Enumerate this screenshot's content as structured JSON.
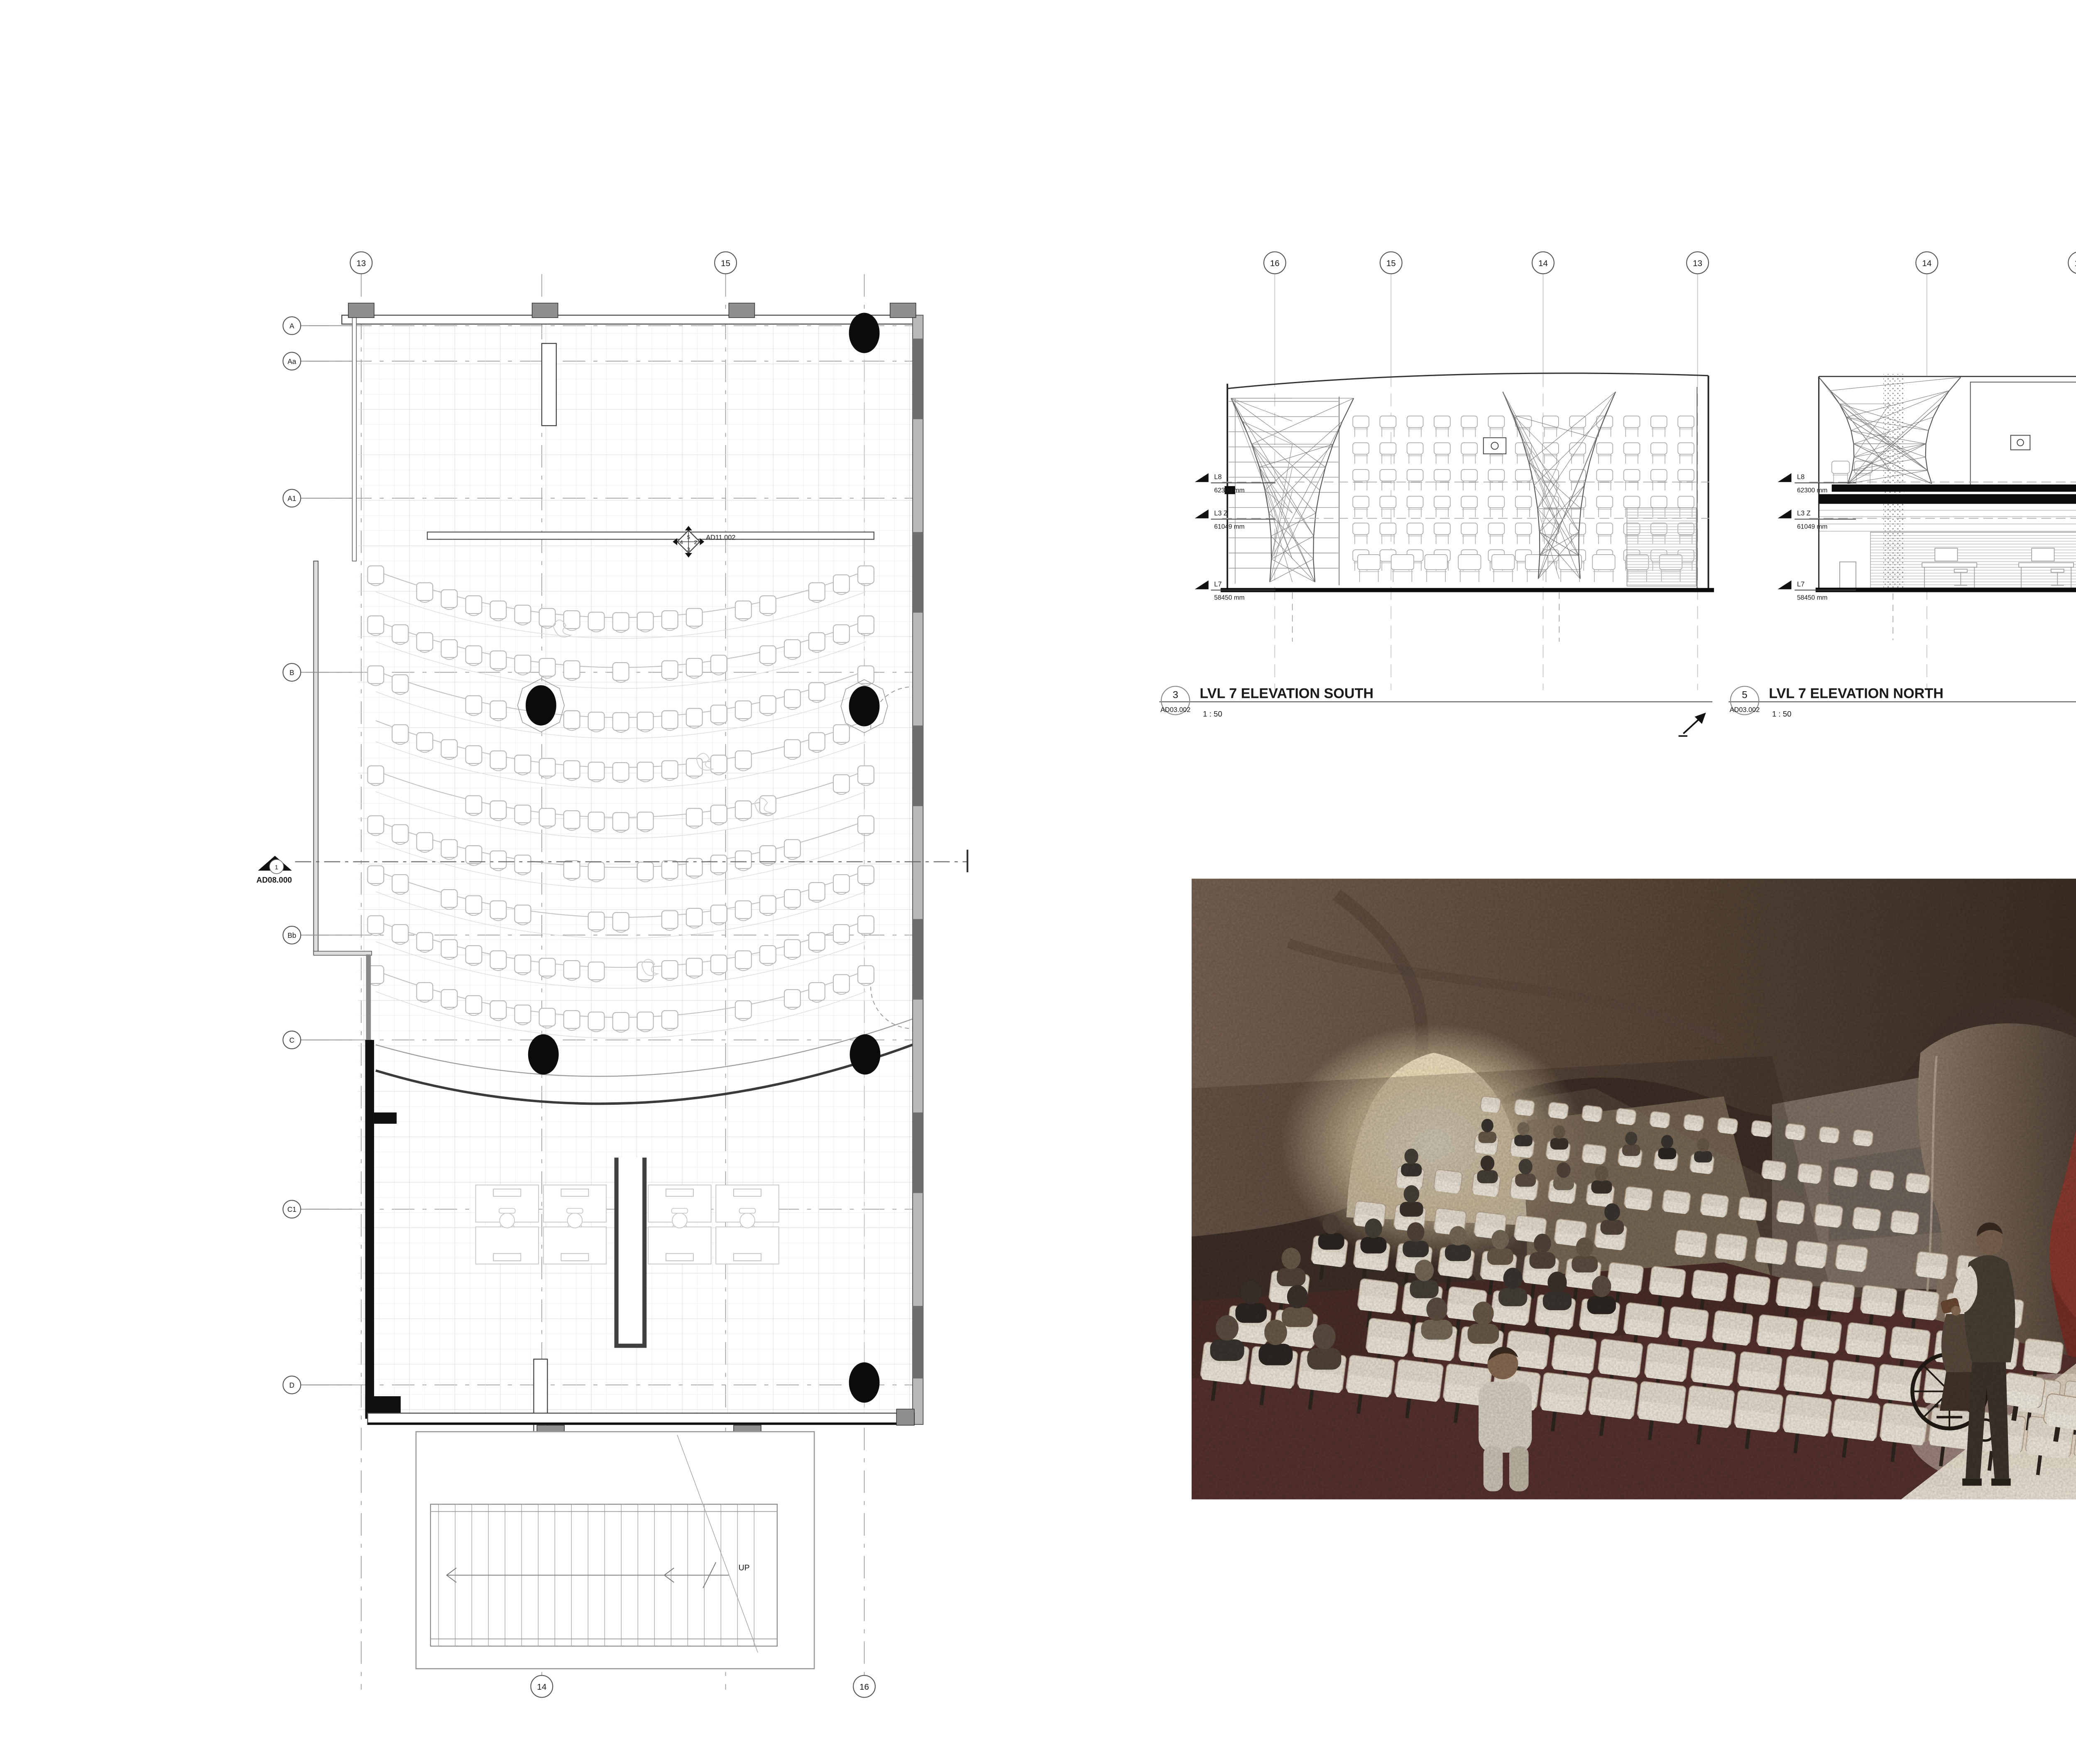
{
  "colors": {
    "paper": "#ffffff",
    "ink": "#1a1a1a",
    "line_mid": "#777777",
    "line_light": "#c9c9c9",
    "render_red_wall": "#7c2f28",
    "render_glow": "#f8edd6",
    "render_carpet": "#56322e",
    "render_seat": "#ebe3d6"
  },
  "plan": {
    "grid_left": [
      "A",
      "Aa",
      "A1",
      "B",
      "Bb",
      "C",
      "C1",
      "D"
    ],
    "grid_top": [
      "13",
      "15"
    ],
    "grid_bottom": [
      "14",
      "16"
    ],
    "section_marker": {
      "number": "1",
      "sheet": "AD08.000"
    },
    "callout": {
      "sheet": "AD11.002",
      "top": "5",
      "right": "2",
      "bottom": "3",
      "left": "4"
    },
    "stair_label": "UP"
  },
  "elevations": {
    "south": {
      "detail_number": "3",
      "sheet_number": "AD03.002",
      "title": "LVL 7 ELEVATION SOUTH",
      "scale": "1 : 50",
      "grid": [
        "16",
        "15",
        "14",
        "13"
      ],
      "levels": [
        {
          "name": "L8",
          "elevation": "62300 mm"
        },
        {
          "name": "L3 Z",
          "elevation": "61049 mm"
        },
        {
          "name": "L7",
          "elevation": "58450 mm"
        }
      ]
    },
    "north": {
      "detail_number": "5",
      "sheet_number": "AD03.002",
      "title": "LVL 7 ELEVATION NORTH",
      "scale": "1 : 50",
      "grid": [
        "14",
        "15",
        "16"
      ],
      "levels": [
        {
          "name": "L8",
          "elevation": "62300 mm"
        },
        {
          "name": "L3 Z",
          "elevation": "61049 mm"
        },
        {
          "name": "L7",
          "elevation": "58450 mm"
        }
      ]
    }
  }
}
